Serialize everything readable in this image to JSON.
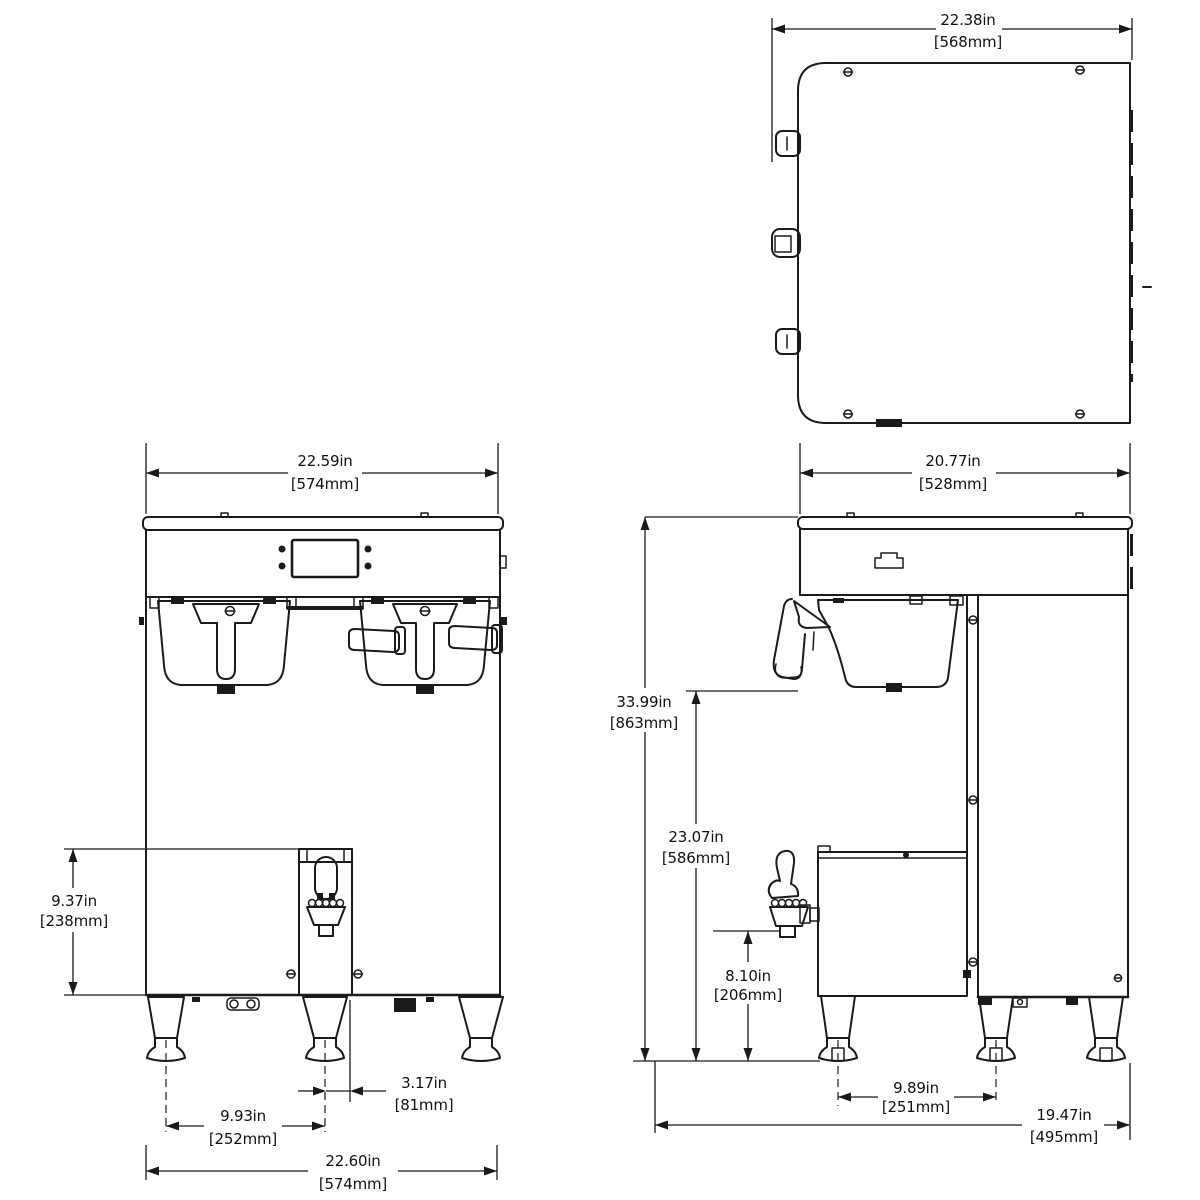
{
  "colors": {
    "line": "#1a1a1a",
    "text": "#111111",
    "background": "#ffffff"
  },
  "views": {
    "top": {
      "dims": {
        "width": {
          "in": "22.38in",
          "mm": "[568mm]"
        }
      }
    },
    "front": {
      "dims": {
        "top_width": {
          "in": "22.59in",
          "mm": "[574mm]"
        },
        "server_height": {
          "in": "9.37in",
          "mm": "[238mm]"
        },
        "center_leg_offset": {
          "in": "3.17in",
          "mm": "[81mm]"
        },
        "leg_spacing": {
          "in": "9.93in",
          "mm": "[252mm]"
        },
        "overall_width": {
          "in": "22.60in",
          "mm": "[574mm]"
        }
      }
    },
    "side": {
      "dims": {
        "top_depth": {
          "in": "20.77in",
          "mm": "[528mm]"
        },
        "overall_height": {
          "in": "33.99in",
          "mm": "[863mm]"
        },
        "counter_height": {
          "in": "23.07in",
          "mm": "[586mm]"
        },
        "faucet_height": {
          "in": "8.10in",
          "mm": "[206mm]"
        },
        "leg_spacing": {
          "in": "9.89in",
          "mm": "[251mm]"
        },
        "overall_depth": {
          "in": "19.47in",
          "mm": "[495mm]"
        }
      }
    }
  }
}
